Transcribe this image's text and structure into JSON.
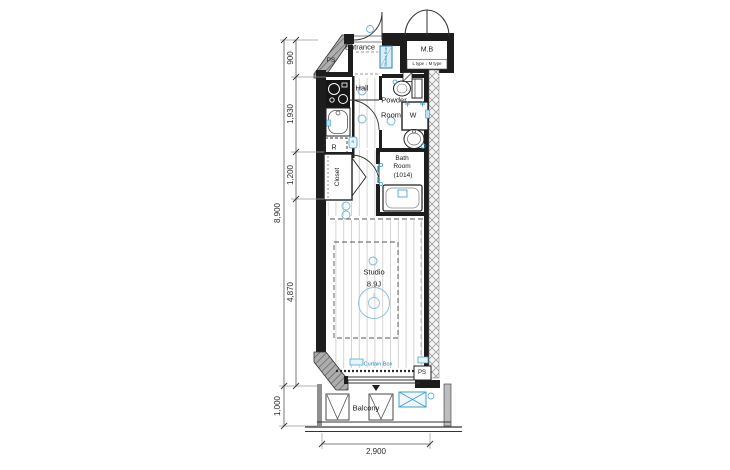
{
  "floorplan": {
    "rooms": {
      "entrance": "Entrance",
      "hall": "Hall",
      "powder_line1": "Powder",
      "powder_line2": "Room",
      "bath_line1": "Bath",
      "bath_line2": "Room",
      "bath_line3": "(1014)",
      "studio_line1": "Studio",
      "studio_line2": "8.9J",
      "closet": "Closet",
      "balcony": "Balcony",
      "meter_box": "M.B",
      "meter_box_types": "L type ↓ M type"
    },
    "fixtures": {
      "pipe_space_top": "PS",
      "pipe_space_bottom": "PS",
      "refrigerator": "R",
      "washer": "W",
      "shoes_box": "Shoes Box",
      "curtain_box": "Curtain Box",
      "bath_remote": "R"
    },
    "dimensions": {
      "left_segments": [
        "900",
        "1,930",
        "1,200",
        "4,870"
      ],
      "left_total": "8,900",
      "balcony_depth": "1,000",
      "bottom_width": "2,900"
    },
    "colors": {
      "wall": "#1d1d1d",
      "accent_blue": "#3d9fcb",
      "hatch_gray": "#adadad"
    }
  }
}
